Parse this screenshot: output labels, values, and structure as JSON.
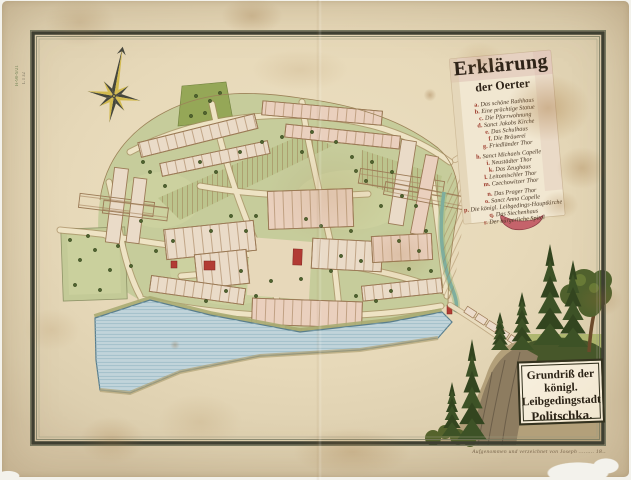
{
  "legend": {
    "title_line1": "Erklärung",
    "title_line2": "der Oerter",
    "items": [
      {
        "key": "a.",
        "text": "Das schöne Rathhaus"
      },
      {
        "key": "b.",
        "text": "Eine prächtige Statue"
      },
      {
        "key": "c.",
        "text": "Die Pfarrwohnung"
      },
      {
        "key": "d.",
        "text": "Sanct Jakobs Kirche"
      },
      {
        "key": "e.",
        "text": "Das Schulhaus"
      },
      {
        "key": "f.",
        "text": "Die Bräuerei"
      },
      {
        "key": "g.",
        "text": "Friedländer Thor"
      },
      {
        "key": "h.",
        "text": "Sanct Michaels Capelle"
      },
      {
        "key": "i.",
        "text": "Neustädter Thor"
      },
      {
        "key": "k.",
        "text": "Das Zeughaus"
      },
      {
        "key": "l.",
        "text": "Leitomischler Thor"
      },
      {
        "key": "m.",
        "text": "Czechowitzer Thor"
      },
      {
        "key": "n.",
        "text": "Das Prager Thor"
      },
      {
        "key": "o.",
        "text": "Sanct Anna Capelle"
      },
      {
        "key": "p.",
        "text": "Die königl. Leibgedings-Hauptkirche"
      },
      {
        "key": "q.",
        "text": "Das Siechenhaus"
      },
      {
        "key": "r.",
        "text": "Der bürgerliche Spital"
      }
    ]
  },
  "cartouche": {
    "lines": [
      "Grundriß der königl.",
      "Leibgedingstadt",
      "Politschka."
    ]
  },
  "caption": "Aufgenommen und verzeichnet von Joseph ……… 18‥",
  "marginalia": {
    "shelfmark": "H-90-9/21",
    "shelfmark2": "L I 32"
  },
  "colors": {
    "paper": "#e7d9b9",
    "ink": "#2b2215",
    "water": "#c1d4da",
    "garden": "#c6cc9b",
    "parcel": "#eadbc8",
    "red_building": "#b23b34",
    "frame_band": "#3e3f31",
    "fir_green": "#33451f",
    "stain_brown": "#b98f56",
    "compass_gold": "#d2ba4e"
  }
}
